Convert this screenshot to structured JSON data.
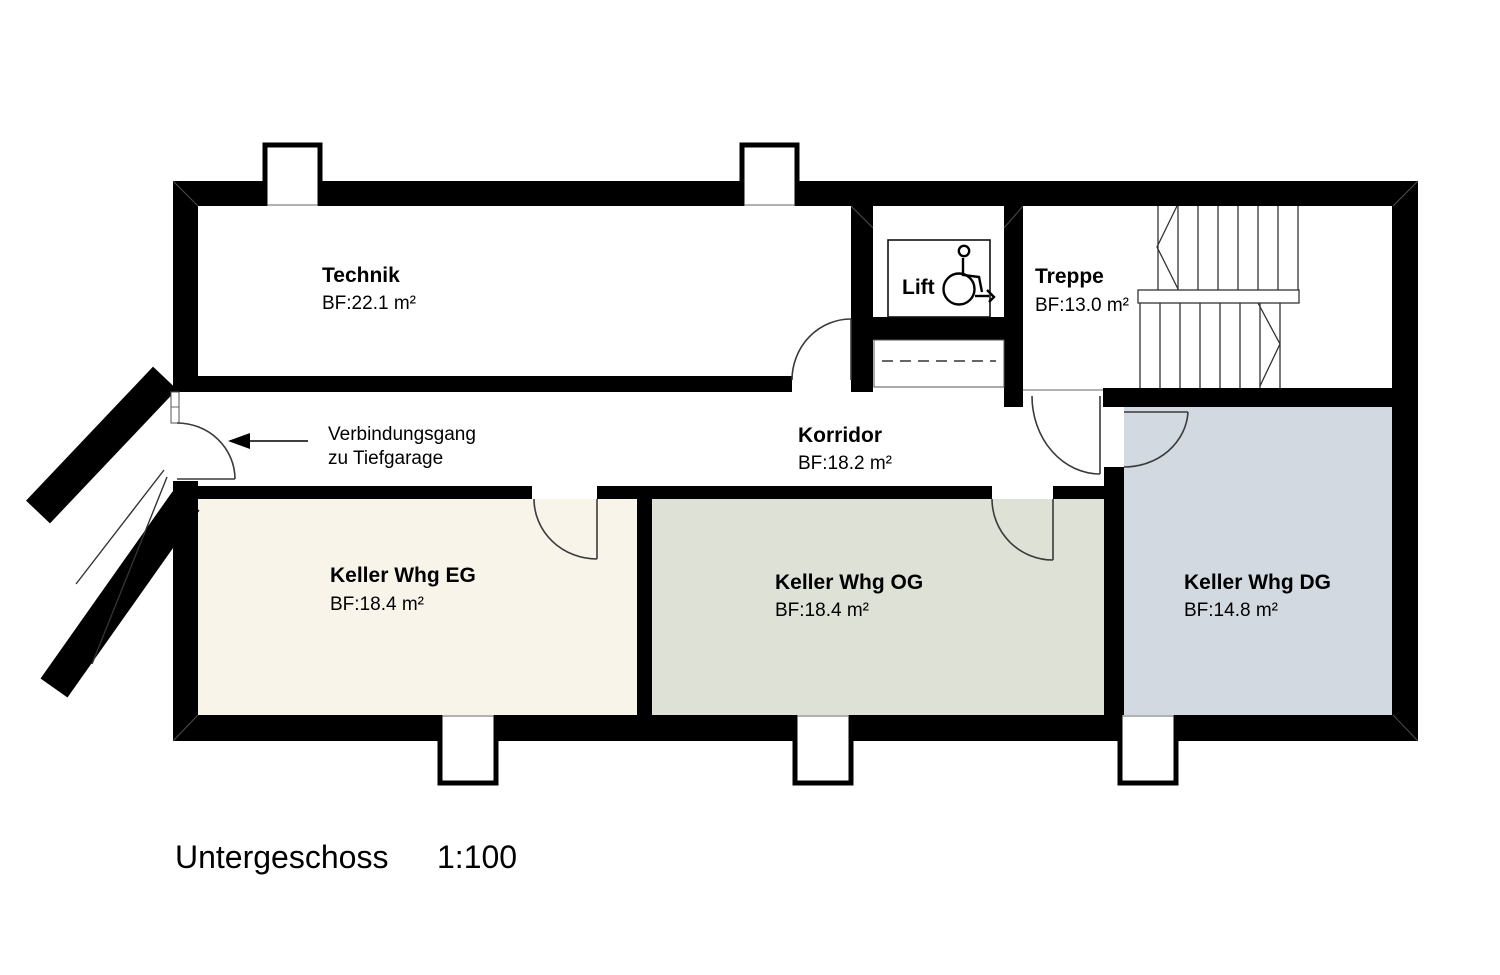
{
  "title": {
    "floor": "Untergeschoss",
    "scale": "1:100"
  },
  "colors": {
    "wall": "#000000",
    "keller_eg_fill": "#f8f4e9",
    "keller_og_fill": "#dee1d6",
    "keller_dg_fill": "#d3d9e1"
  },
  "rooms": {
    "technik": {
      "name": "Technik",
      "area": "BF:22.1 m²"
    },
    "lift": {
      "name": "Lift"
    },
    "treppe": {
      "name": "Treppe",
      "area": "BF:13.0 m²"
    },
    "korridor": {
      "name": "Korridor",
      "area": "BF:18.2 m²"
    },
    "keller_eg": {
      "name": "Keller Whg EG",
      "area": "BF:18.4 m²"
    },
    "keller_og": {
      "name": "Keller Whg OG",
      "area": "BF:18.4 m²"
    },
    "keller_dg": {
      "name": "Keller Whg DG",
      "area": "BF:14.8 m²"
    }
  },
  "annotations": {
    "garage_line1": "Verbindungsgang",
    "garage_line2": "zu Tiefgarage"
  },
  "icons": {
    "lift_symbol": "wheelchair-accessible-icon"
  }
}
